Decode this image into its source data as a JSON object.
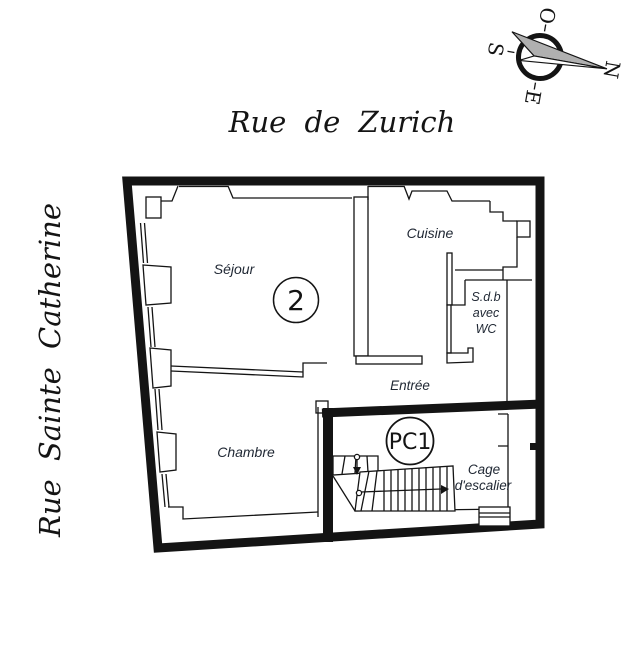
{
  "title": "Plan d'appartement",
  "streets": {
    "top": "Rue de Zurich",
    "left": "Rue Sainte Catherine"
  },
  "rooms": {
    "sejour": "Séjour",
    "cuisine": "Cuisine",
    "sdb": [
      "S.d.b",
      "avec",
      "WC"
    ],
    "entree": "Entrée",
    "chambre": "Chambre",
    "cage": [
      "Cage",
      "d'escalier"
    ]
  },
  "badges": {
    "apartment": "2",
    "pc": "PC1"
  },
  "compass": {
    "letters": {
      "n": "N",
      "e": "E",
      "s": "S",
      "o": "O"
    }
  },
  "colors": {
    "wall": "#141414",
    "label": "#1f2733",
    "needle": "#b0b0b0",
    "paper": "#ffffff"
  }
}
